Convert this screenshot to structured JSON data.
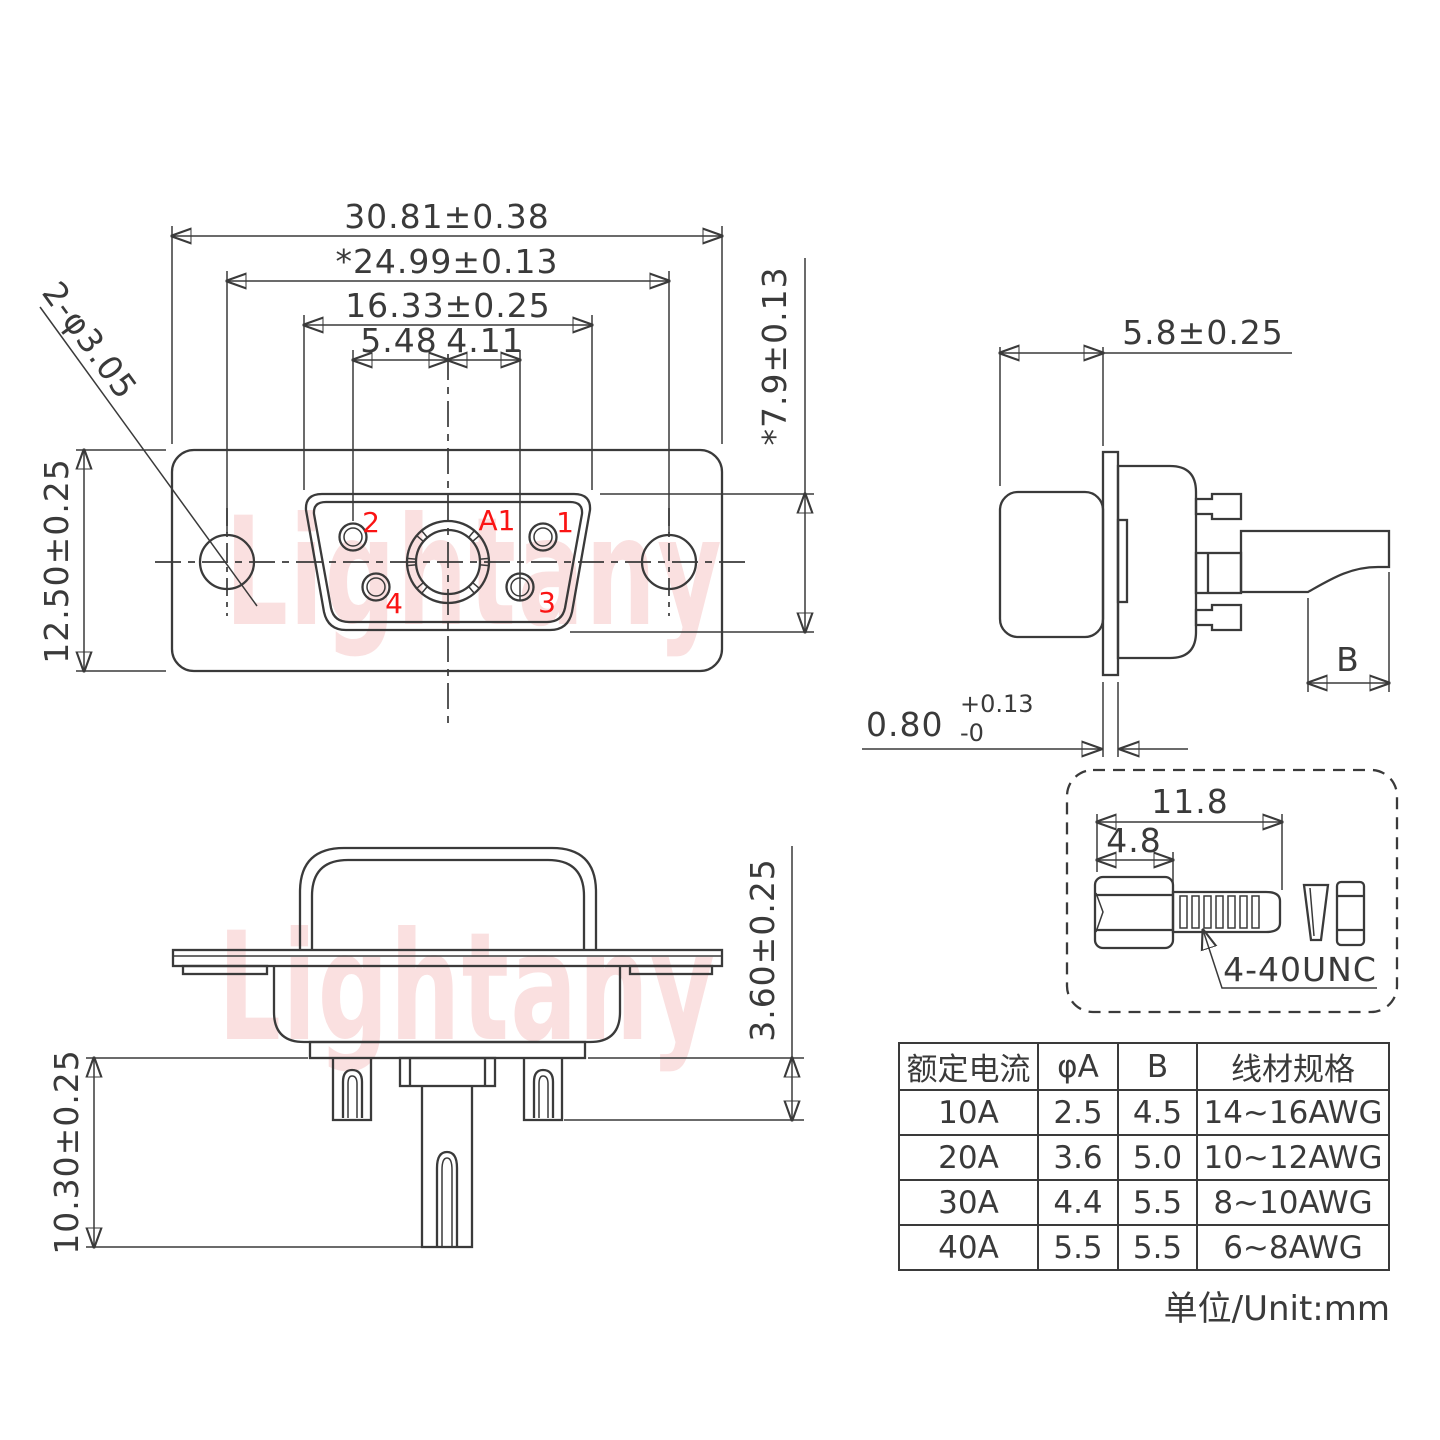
{
  "watermark": {
    "text": "Lightany"
  },
  "front_view": {
    "dim_total": "30.81±0.38",
    "dim_mount": "*24.99±0.13",
    "dim_insert": "16.33±0.25",
    "dim_pitch_left": "5.48",
    "dim_pitch_right": "4.11",
    "dim_height": "12.50±0.25",
    "dim_insert_height": "*7.9±0.13",
    "dim_holes": "2-φ3.05",
    "pins": {
      "a1": "A1",
      "p1": "1",
      "p2": "2",
      "p3": "3",
      "p4": "4"
    }
  },
  "side_view": {
    "dim_depth": "5.8±0.25",
    "dim_thickness": "0.80",
    "tol_plus": "+0.13",
    "tol_minus": "-0",
    "dim_b": "B"
  },
  "bottom_view": {
    "dim_tail_len": "10.30±0.25",
    "dim_insulator": "3.60±0.25"
  },
  "screw_detail": {
    "dim_length": "11.8",
    "dim_head": "4.8",
    "thread_label": "4-40UNC"
  },
  "spec_table": {
    "headers": [
      "额定电流",
      "φA",
      "B",
      "线材规格"
    ],
    "rows": [
      [
        "10A",
        "2.5",
        "4.5",
        "14~16AWG"
      ],
      [
        "20A",
        "3.6",
        "5.0",
        "10~12AWG"
      ],
      [
        "30A",
        "4.4",
        "5.5",
        "8~10AWG"
      ],
      [
        "40A",
        "5.5",
        "5.5",
        "6~8AWG"
      ]
    ]
  },
  "unit_label": "单位/Unit:mm"
}
